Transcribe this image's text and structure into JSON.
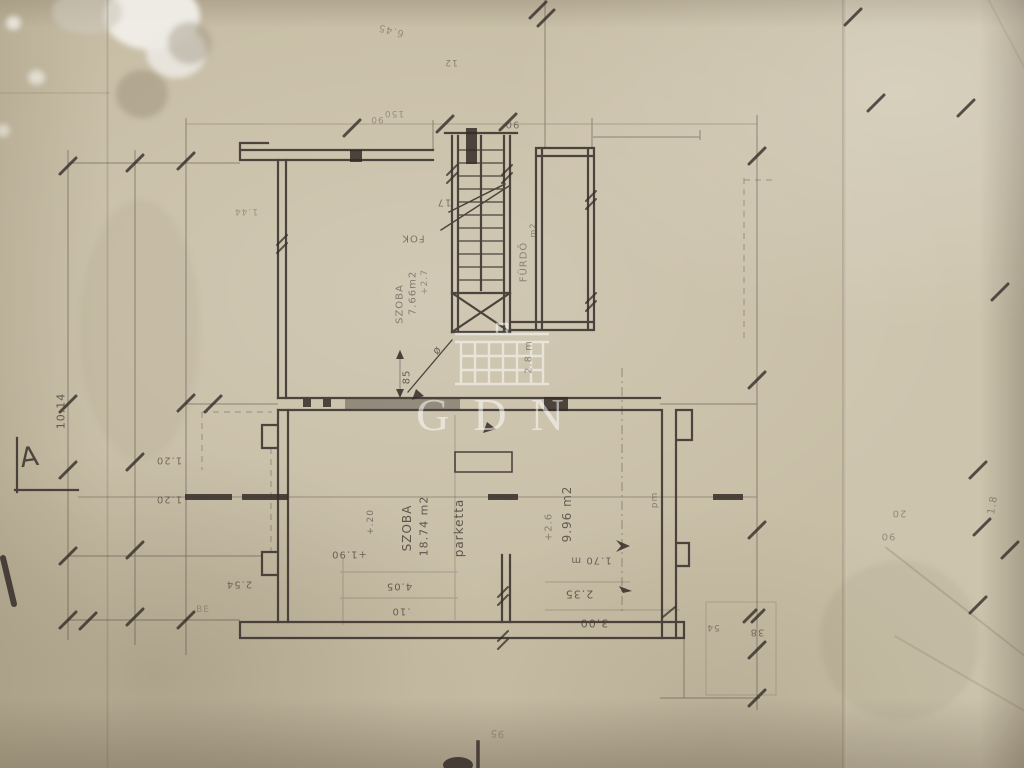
{
  "document": {
    "kind": "photograph of hand-drawn architectural floor plan, rotated 90 degrees on aged paper",
    "colors": {
      "paper": "#c8bea6",
      "ink": "#39312d",
      "pencil": "#7b7060",
      "watermark": "#ffffff"
    }
  },
  "watermark": {
    "text": "GDN",
    "color": "#ffffff"
  },
  "section_marker": {
    "label": "A"
  },
  "rooms": [
    {
      "name": "SZOBA",
      "area": "18.74 m2",
      "flooring": "parketta"
    },
    {
      "name": "SZOBA",
      "area": "7.66m2",
      "flooring": ""
    },
    {
      "name": "FÜRDŐ",
      "area": "",
      "flooring": ""
    },
    {
      "name": "",
      "area": "9.96 m2",
      "flooring": ""
    }
  ],
  "annotations": {
    "stairs": "17 FOK"
  },
  "labels": [
    {
      "text": "SZOBA",
      "x": 407,
      "y": 528,
      "r": -90,
      "s": 12,
      "o": 0.8,
      "cls": "ink"
    },
    {
      "text": "18.74 m2",
      "x": 424,
      "y": 526,
      "r": -90,
      "s": 11,
      "o": 0.8,
      "cls": "ink"
    },
    {
      "text": "parketta",
      "x": 459,
      "y": 528,
      "r": -90,
      "s": 12,
      "o": 0.8,
      "cls": "ink"
    },
    {
      "text": "9.96 m2",
      "x": 567,
      "y": 514,
      "r": -90,
      "s": 12,
      "o": 0.75,
      "cls": "ink"
    },
    {
      "text": "+2.6",
      "x": 549,
      "y": 527,
      "r": -90,
      "s": 10,
      "o": 0.5,
      "cls": "ink"
    },
    {
      "text": "2.8 m",
      "x": 529,
      "y": 357,
      "r": -90,
      "s": 10,
      "o": 0.5,
      "cls": "ink"
    },
    {
      "text": "1.70 m",
      "x": 591,
      "y": 560,
      "r": 180,
      "s": 10,
      "o": 0.7,
      "cls": "ink"
    },
    {
      "text": "2.35",
      "x": 579,
      "y": 594,
      "r": 180,
      "s": 11,
      "o": 0.75,
      "cls": "ink"
    },
    {
      "text": "3.00",
      "x": 594,
      "y": 623,
      "r": 180,
      "s": 11,
      "o": 0.75,
      "cls": "ink"
    },
    {
      "text": "4.05",
      "x": 399,
      "y": 586,
      "r": 180,
      "s": 10,
      "o": 0.75,
      "cls": "ink"
    },
    {
      "text": ".10",
      "x": 401,
      "y": 611,
      "r": 180,
      "s": 10,
      "o": 0.7,
      "cls": "ink"
    },
    {
      "text": "+1.90",
      "x": 349,
      "y": 554,
      "r": 180,
      "s": 10,
      "o": 0.7,
      "cls": "ink"
    },
    {
      "text": "+.20",
      "x": 371,
      "y": 522,
      "r": -90,
      "s": 9,
      "o": 0.6,
      "cls": "ink"
    },
    {
      "text": "85",
      "x": 407,
      "y": 377,
      "r": -90,
      "s": 10,
      "o": 0.75,
      "cls": "ink"
    },
    {
      "text": "ø",
      "x": 437,
      "y": 350,
      "r": -50,
      "s": 11,
      "o": 0.7,
      "cls": "ink"
    },
    {
      "text": "SZOBA",
      "x": 400,
      "y": 304,
      "r": -90,
      "s": 10,
      "o": 0.55,
      "cls": "ink"
    },
    {
      "text": "7.66m2",
      "x": 413,
      "y": 293,
      "r": -90,
      "s": 10,
      "o": 0.55,
      "cls": "ink"
    },
    {
      "text": "+2.7",
      "x": 425,
      "y": 282,
      "r": -90,
      "s": 9,
      "o": 0.45,
      "cls": "ink"
    },
    {
      "text": "17",
      "x": 444,
      "y": 202,
      "r": 180,
      "s": 10,
      "o": 0.6,
      "cls": "ink"
    },
    {
      "text": "FOK",
      "x": 413,
      "y": 238,
      "r": 180,
      "s": 10,
      "o": 0.6,
      "cls": "ink"
    },
    {
      "text": "FÜRDŐ",
      "x": 524,
      "y": 262,
      "r": -90,
      "s": 10,
      "o": 0.5,
      "cls": "ink"
    },
    {
      "text": "m2",
      "x": 533,
      "y": 230,
      "r": -90,
      "s": 8,
      "o": 0.5,
      "cls": "ink"
    },
    {
      "text": "10.14",
      "x": 61,
      "y": 411,
      "r": -90,
      "s": 11,
      "o": 0.75,
      "cls": "ink"
    },
    {
      "text": "2.54",
      "x": 239,
      "y": 584,
      "r": 180,
      "s": 10,
      "o": 0.65,
      "cls": "ink"
    },
    {
      "text": "BE",
      "x": 203,
      "y": 610,
      "r": 0,
      "s": 9,
      "o": 0.5,
      "cls": "pencil"
    },
    {
      "text": "90",
      "x": 377,
      "y": 119,
      "r": 180,
      "s": 9,
      "o": 0.55,
      "cls": "pencil"
    },
    {
      "text": "150",
      "x": 394,
      "y": 113,
      "r": 180,
      "s": 9,
      "o": 0.55,
      "cls": "pencil"
    },
    {
      "text": "90",
      "x": 512,
      "y": 124,
      "r": 180,
      "s": 10,
      "o": 0.6,
      "cls": "ink"
    },
    {
      "text": "12",
      "x": 451,
      "y": 62,
      "r": 180,
      "s": 9,
      "o": 0.5,
      "cls": "ink"
    },
    {
      "text": "6.45",
      "x": 391,
      "y": 30,
      "r": 195,
      "s": 10,
      "o": 0.55,
      "cls": "pencil"
    },
    {
      "text": "pm",
      "x": 655,
      "y": 500,
      "r": -90,
      "s": 9,
      "o": 0.5,
      "cls": "ink"
    },
    {
      "text": "20",
      "x": 899,
      "y": 513,
      "r": 180,
      "s": 10,
      "o": 0.6,
      "cls": "pencil"
    },
    {
      "text": "90",
      "x": 888,
      "y": 536,
      "r": 180,
      "s": 10,
      "o": 0.6,
      "cls": "pencil"
    },
    {
      "text": "1.8",
      "x": 993,
      "y": 505,
      "r": -80,
      "s": 10,
      "o": 0.65,
      "cls": "pencil"
    },
    {
      "text": "1.44",
      "x": 246,
      "y": 211,
      "r": 180,
      "s": 9,
      "o": 0.5,
      "cls": "pencil"
    },
    {
      "text": "95",
      "x": 497,
      "y": 733,
      "r": 185,
      "s": 10,
      "o": 0.5,
      "cls": "pencil"
    },
    {
      "text": "1.20",
      "x": 169,
      "y": 460,
      "r": 180,
      "s": 10,
      "o": 0.65,
      "cls": "ink"
    },
    {
      "text": "1.20",
      "x": 169,
      "y": 499,
      "r": 180,
      "s": 10,
      "o": 0.65,
      "cls": "ink"
    },
    {
      "text": "54",
      "x": 713,
      "y": 627,
      "r": 180,
      "s": 9,
      "o": 0.5,
      "cls": "ink"
    },
    {
      "text": "38",
      "x": 757,
      "y": 632,
      "r": 180,
      "s": 10,
      "o": 0.6,
      "cls": "ink"
    }
  ]
}
